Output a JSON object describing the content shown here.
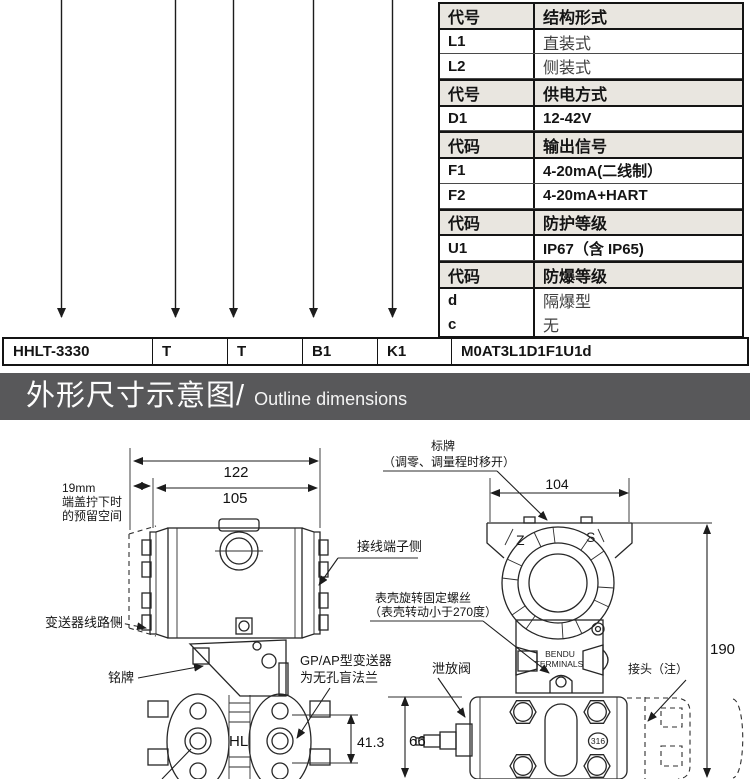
{
  "spec_table": {
    "rows": [
      {
        "code": "代号",
        "desc": "结构形式"
      },
      {
        "code": "L1",
        "desc": "直装式"
      },
      {
        "code": "L2",
        "desc": "侧装式"
      },
      {
        "code": "代号",
        "desc": "供电方式"
      },
      {
        "code": "D1",
        "desc": "12-42V"
      },
      {
        "code": "代码",
        "desc": "输出信号"
      },
      {
        "code": "F1",
        "desc": "4-20mA(二线制）"
      },
      {
        "code": "F2",
        "desc": "4-20mA+HART"
      },
      {
        "code": "代码",
        "desc": "防护等级"
      },
      {
        "code": "U1",
        "desc": "IP67（含 IP65)"
      },
      {
        "code": "代码",
        "desc": "防爆等级"
      },
      {
        "code": "d",
        "desc": "隔爆型"
      },
      {
        "code": "c",
        "desc": "无"
      }
    ]
  },
  "model_row": {
    "cells": [
      "HHLT-3330",
      "T",
      "T",
      "B1",
      "K1",
      "M0AT3L1D1F1U1d"
    ]
  },
  "section_banner": {
    "title_zh": "外形尺寸示意图/",
    "title_en": "Outline dimensions"
  },
  "drawing": {
    "left": {
      "dim_width_full": "122",
      "dim_width_body": "105",
      "reserve_space": [
        "19mm",
        "端盖拧下时",
        "的预留空间"
      ],
      "terminal_side": "接线端子侧",
      "circuit_side": "变送器线路侧",
      "nameplate": "铭牌",
      "blind_flange": [
        "GP/AP型变送器",
        "为无孔盲法兰"
      ],
      "hl": "HL",
      "dim_flange": "41.3"
    },
    "right": {
      "tag_plate": [
        "标牌",
        "（调零、调量程时移开）"
      ],
      "dim_top": "104",
      "zero_mark": "Z",
      "span_mark": "S",
      "case_screw": [
        "表壳旋转固定螺丝",
        "（表壳转动小于270度）"
      ],
      "terminals": [
        "BENDU",
        "TERMINALS"
      ],
      "drain_valve": "泄放阀",
      "connector_note": "接头（注）",
      "dim_height": "190",
      "dim_flange_height": "66",
      "material": "316"
    }
  },
  "colors": {
    "banner_bg": "#58585a",
    "table_header_bg": "#e9e6e0",
    "line": "#262626"
  }
}
